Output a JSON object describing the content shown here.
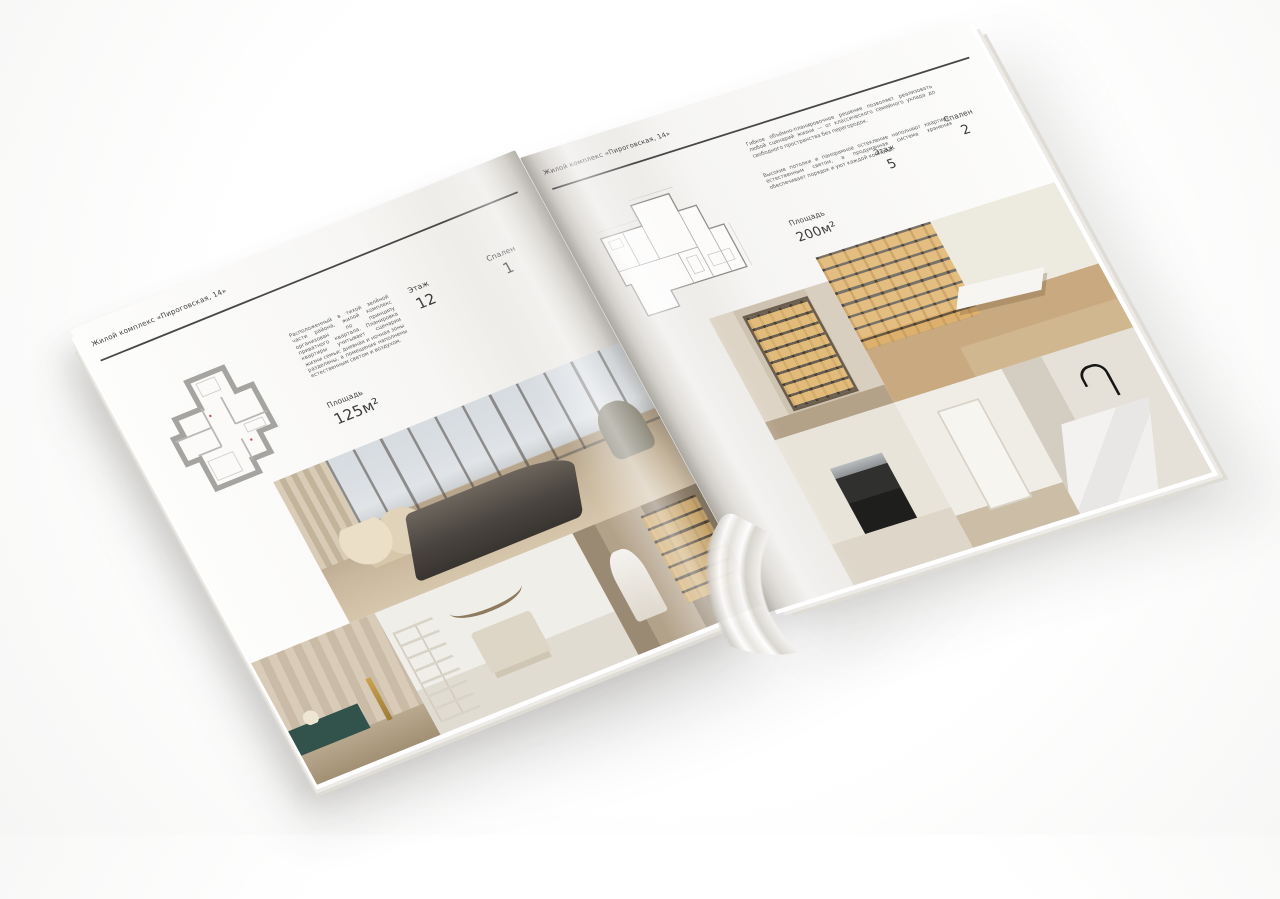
{
  "colors": {
    "page_background": "#f7f6f4",
    "ink": "#3c3c3c",
    "rule": "#474747",
    "shelf_glow": "#e2b268",
    "console_teal": "#32524c"
  },
  "left_page": {
    "header": "Жилой комплекс «Пироговская, 14»",
    "description": "Расположенный в тихой зелёной части района, жилой комплекс организован по принципу приватного квартала. Планировка квартиры учитывает сценарии жизни семьи: дневная и ночная зоны разделены, а помещения наполнены естественным светом и воздухом.",
    "specs": {
      "area_label": "Площадь",
      "area_value": "125м²",
      "floor_label": "Этаж",
      "floor_value": "12",
      "bedrooms_label": "Спален",
      "bedrooms_value": "1"
    }
  },
  "right_page": {
    "header": "Жилой комплекс «Пироговская, 14»",
    "description_1": "Гибкое объёмно-планировочное решение позволяет реализовать любой сценарий жизни — от классического семейного уклада до свободного пространства без перегородок.",
    "description_2": "Высокие потолки и панорамное остекление наполняют квартиру естественным светом, а продуманная система хранения обеспечивает порядок и уют каждой комнаты.",
    "specs": {
      "area_label": "Площадь",
      "area_value": "200м²",
      "floor_label": "Этаж",
      "floor_value": "5",
      "bedrooms_label": "Спален",
      "bedrooms_value": "2"
    }
  },
  "photos": {
    "left": [
      "bedroom-panorama",
      "wardrobe-detail",
      "white-bedroom",
      "corridor-library"
    ],
    "right": [
      "study-library",
      "display-cabinet-hall",
      "kitchen",
      "white-hallway",
      "bathroom-marble"
    ]
  }
}
